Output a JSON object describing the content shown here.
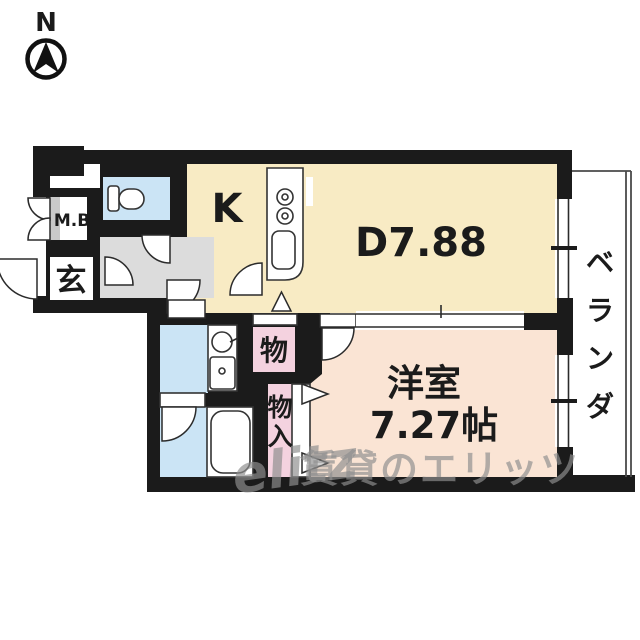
{
  "compass": {
    "north_label": "N"
  },
  "labels": {
    "meter_box": "M.B",
    "entrance": "玄",
    "kitchen": "K",
    "dining": "D7.88",
    "western_room": "洋室",
    "western_room_size": "7.27帖",
    "storage": "物",
    "closet": "物入",
    "veranda": "ベランダ"
  },
  "watermark": {
    "logo_script": "elitz",
    "text": "賃貸のエリッツ"
  },
  "colors": {
    "wall": "#1b1b1b",
    "kitchen_dining_floor": "#f8ebc4",
    "western_room_floor": "#fae4d4",
    "wet_area_floor": "#cbe4f5",
    "closet_pink": "#f4d2df",
    "hallway_gray": "#dcdcdc",
    "watermark_gray": "#8f8f8f"
  }
}
